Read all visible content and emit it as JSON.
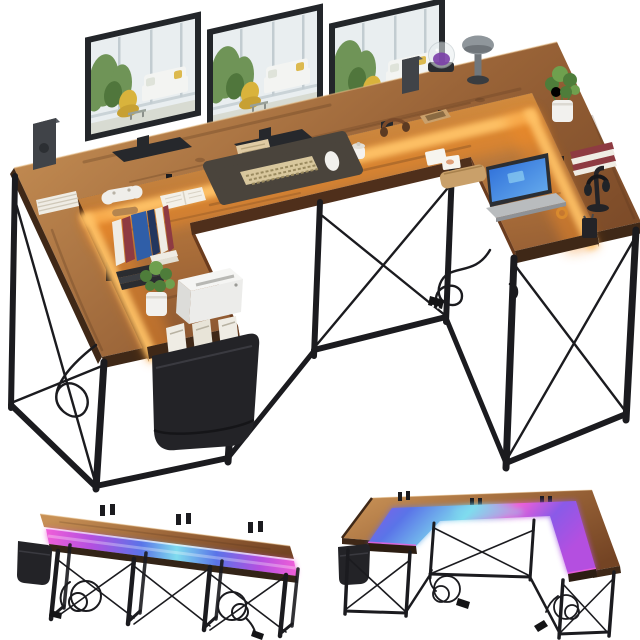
{
  "meta": {
    "type": "product-photo",
    "subject": "U-shaped computer desk with power outlets, LED light strip, monitor shelf hutch, and side storage bag",
    "background": "#ffffff",
    "views": [
      {
        "id": "main",
        "label": "U-shaped desk styled with monitors and office accessories, warm under-shelf lighting"
      },
      {
        "id": "thumb-front-led",
        "label": "Desk front view with RGB LED strip glowing pink-blue-cyan"
      },
      {
        "id": "thumb-u-led",
        "label": "U-shaped desk with RGB LED strip glowing magenta-blue-cyan"
      }
    ]
  },
  "palette": {
    "background": "#ffffff",
    "wood_light": "#c79055",
    "wood_mid": "#9a6438",
    "wood_dark": "#744424",
    "wood_edge": "#3f2817",
    "desk_lit": "#eb9c3e",
    "desk_mid": "#b5763c",
    "desk_shade": "#855230",
    "glow_core": "#ffc368",
    "glow_warm": "#f08a28",
    "frame_black": "#1b1b1f",
    "bag_black": "#232327",
    "monitor_frame": "#23262a",
    "stand_dark": "#26282c",
    "screen_bg": "#e9eef0",
    "screen_green": "#6f9457",
    "screen_green_dark": "#50763c",
    "screen_yellow": "#d9b33c",
    "screen_white": "#f3f4f2",
    "screen_floor": "#d8dbd2",
    "window_gray": "#c2ccd1",
    "led_pink": "#f05fd8",
    "led_magenta": "#b44fe0",
    "led_violet": "#8a5ae8",
    "led_blue": "#5a74e8",
    "led_cyan": "#7fdcee",
    "plant_green": "#4e7d3a",
    "plant_green_light": "#6fa04e",
    "pot_white": "#f2f1ee",
    "paper_white": "#efece4",
    "book_red": "#8e3b42",
    "book_blue": "#2f5ea8",
    "book_navy": "#24365e",
    "tan_leather": "#c9a06a",
    "beige_wood": "#e0cba4",
    "laptop_silver": "#b9bcbe",
    "laptop_screen_blue": "#2b6bd8",
    "laptop_screen_light": "#6ab0ee",
    "lamp_gray": "#8f969b",
    "dome_purple": "#7b3fa8",
    "speaker_gray": "#404348"
  },
  "scene": {
    "main_view": {
      "desk": "U-shaped desk, rustic brown woodgrain top, raised monitor shelf around outer edge, black steel frame with X cross-braces",
      "objects": [
        "three monitors showing a living-room scene",
        "left bookshelf speaker",
        "right bookshelf speaker",
        "stack of documents on left shelf",
        "glass dome smart lamp with purple glow",
        "gray mushroom desk lamp",
        "potted plant on right shelf",
        "stacked red books on right shelf",
        "headphone stand with headphones",
        "black pen cup",
        "white game controller",
        "wooden roller",
        "upright books and blue folder",
        "stack of black laptops",
        "potted plant on left wing",
        "white printer",
        "wooden media box",
        "desk mat with keyboard and mouse",
        "open book",
        "white ceramic jar",
        "headphones on desktop",
        "wooden tray",
        "photo prints",
        "tan leather pouch",
        "laptop with blue screen",
        "orange wrist watch",
        "black side storage bag holding magazines",
        "power cable with two-prong plug",
        "warm LED under-shelf glow"
      ]
    },
    "thumb_front_view": {
      "led_effect": "pink to blue to cyan RGB strip across the desktop",
      "objects": [
        "long desk front view",
        "raised monitor shelf",
        "black storage bag",
        "four leg pairs with X braces",
        "two coiled power cables with plugs"
      ]
    },
    "thumb_u_view": {
      "led_effect": "magenta, blue and cyan RGB glow across the U-shaped desktop",
      "objects": [
        "U-shaped desk",
        "wood shelf ring",
        "black storage bag",
        "black frame with X braces",
        "two coiled power cables with plugs"
      ]
    }
  }
}
